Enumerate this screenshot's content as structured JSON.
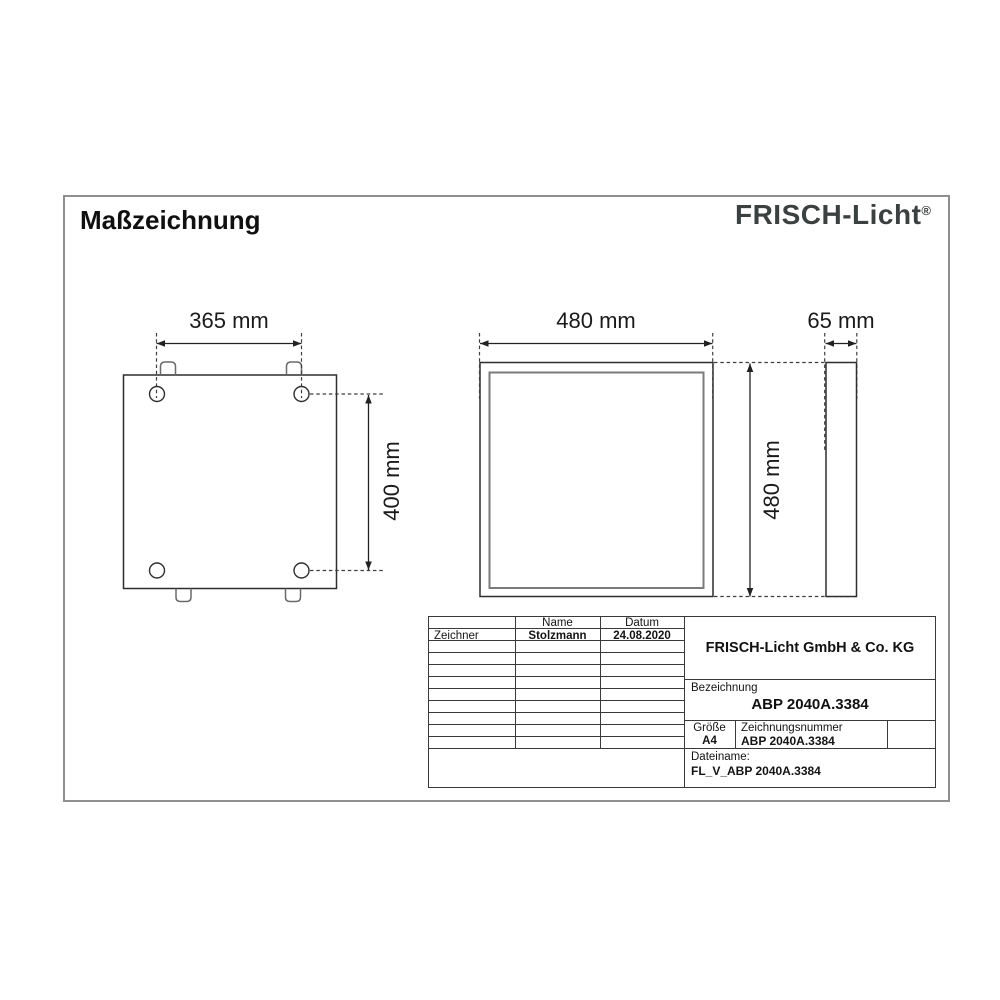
{
  "header": {
    "title": "Maßzeichnung",
    "brand": "FRISCH-Licht",
    "registered": "®"
  },
  "dimensions": {
    "mount_width": "365 mm",
    "mount_height": "400 mm",
    "panel_width": "480 mm",
    "panel_height": "480 mm",
    "panel_depth": "65 mm"
  },
  "title_block": {
    "header_name": "Name",
    "header_datum": "Datum",
    "zeichner_label": "Zeichner",
    "zeichner_name": "Stolzmann",
    "zeichner_datum": "24.08.2020",
    "company": "FRISCH-Licht GmbH & Co. KG",
    "bezeichnung_label": "Bezeichnung",
    "bezeichnung": "ABP 2040A.3384",
    "groesse_label": "Größe",
    "groesse": "A4",
    "zeichnungsnummer_label": "Zeichnungsnummer",
    "zeichnungsnummer": "ABP 2040A.3384",
    "dateiname_label": "Dateiname:",
    "dateiname": "FL_V_ABP 2040A.3384"
  },
  "colors": {
    "drawing_line": "#2e2e2e",
    "gray_line": "#7b7b7b",
    "page_border": "#8f8f8f",
    "brand_color": "#3b4140"
  }
}
